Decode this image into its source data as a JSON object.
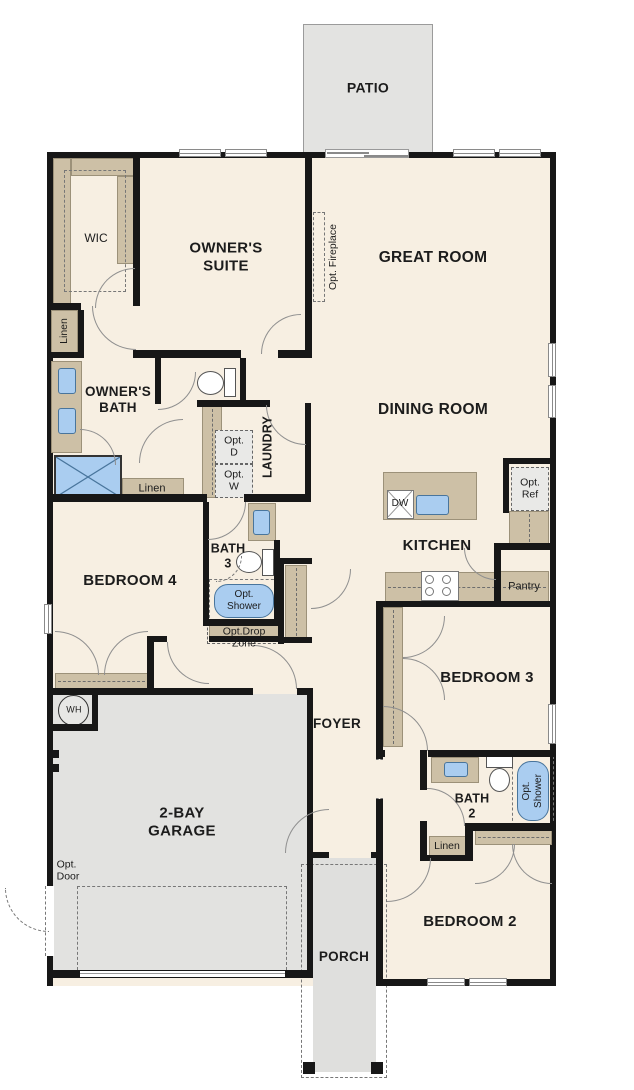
{
  "colors": {
    "floor_cream": "#f7efe2",
    "wall_black": "#171717",
    "closet_tan": "#cdc0a6",
    "outdoor_gray": "#e2e2e0",
    "fixture_blue": "#aacdf0",
    "optional_fill": "#e9e9e7"
  },
  "rooms": {
    "patio": {
      "label": "PATIO"
    },
    "owners_suite": {
      "label": "OWNER'S\nSUITE",
      "wic": "WIC"
    },
    "great_room": {
      "label": "GREAT ROOM",
      "opt_fireplace": "Opt. Fireplace"
    },
    "owners_bath": {
      "label": "OWNER'S\nBATH",
      "linen_side": "Linen",
      "linen": "Linen"
    },
    "laundry": {
      "label": "LAUNDRY",
      "opt_d": "Opt.\nD",
      "opt_w": "Opt.\nW"
    },
    "dining_room": {
      "label": "DINING ROOM"
    },
    "kitchen": {
      "label": "KITCHEN",
      "dw": "DW",
      "opt_ref": "Opt.\nRef",
      "pantry": "Pantry"
    },
    "bath3": {
      "label": "BATH\n3",
      "opt_shower": "Opt.\nShower",
      "drop_zone": "Opt.Drop\nZone"
    },
    "bedroom4": {
      "label": "BEDROOM 4"
    },
    "garage": {
      "label": "2-BAY\nGARAGE",
      "water_heater": "WH",
      "opt_door": "Opt.\nDoor"
    },
    "foyer": {
      "label": "FOYER"
    },
    "bedroom3": {
      "label": "BEDROOM 3"
    },
    "bath2": {
      "label": "BATH\n2",
      "opt_shower": "Opt.\nShower",
      "linen": "Linen"
    },
    "bedroom2": {
      "label": "BEDROOM 2"
    },
    "porch": {
      "label": "PORCH"
    }
  }
}
